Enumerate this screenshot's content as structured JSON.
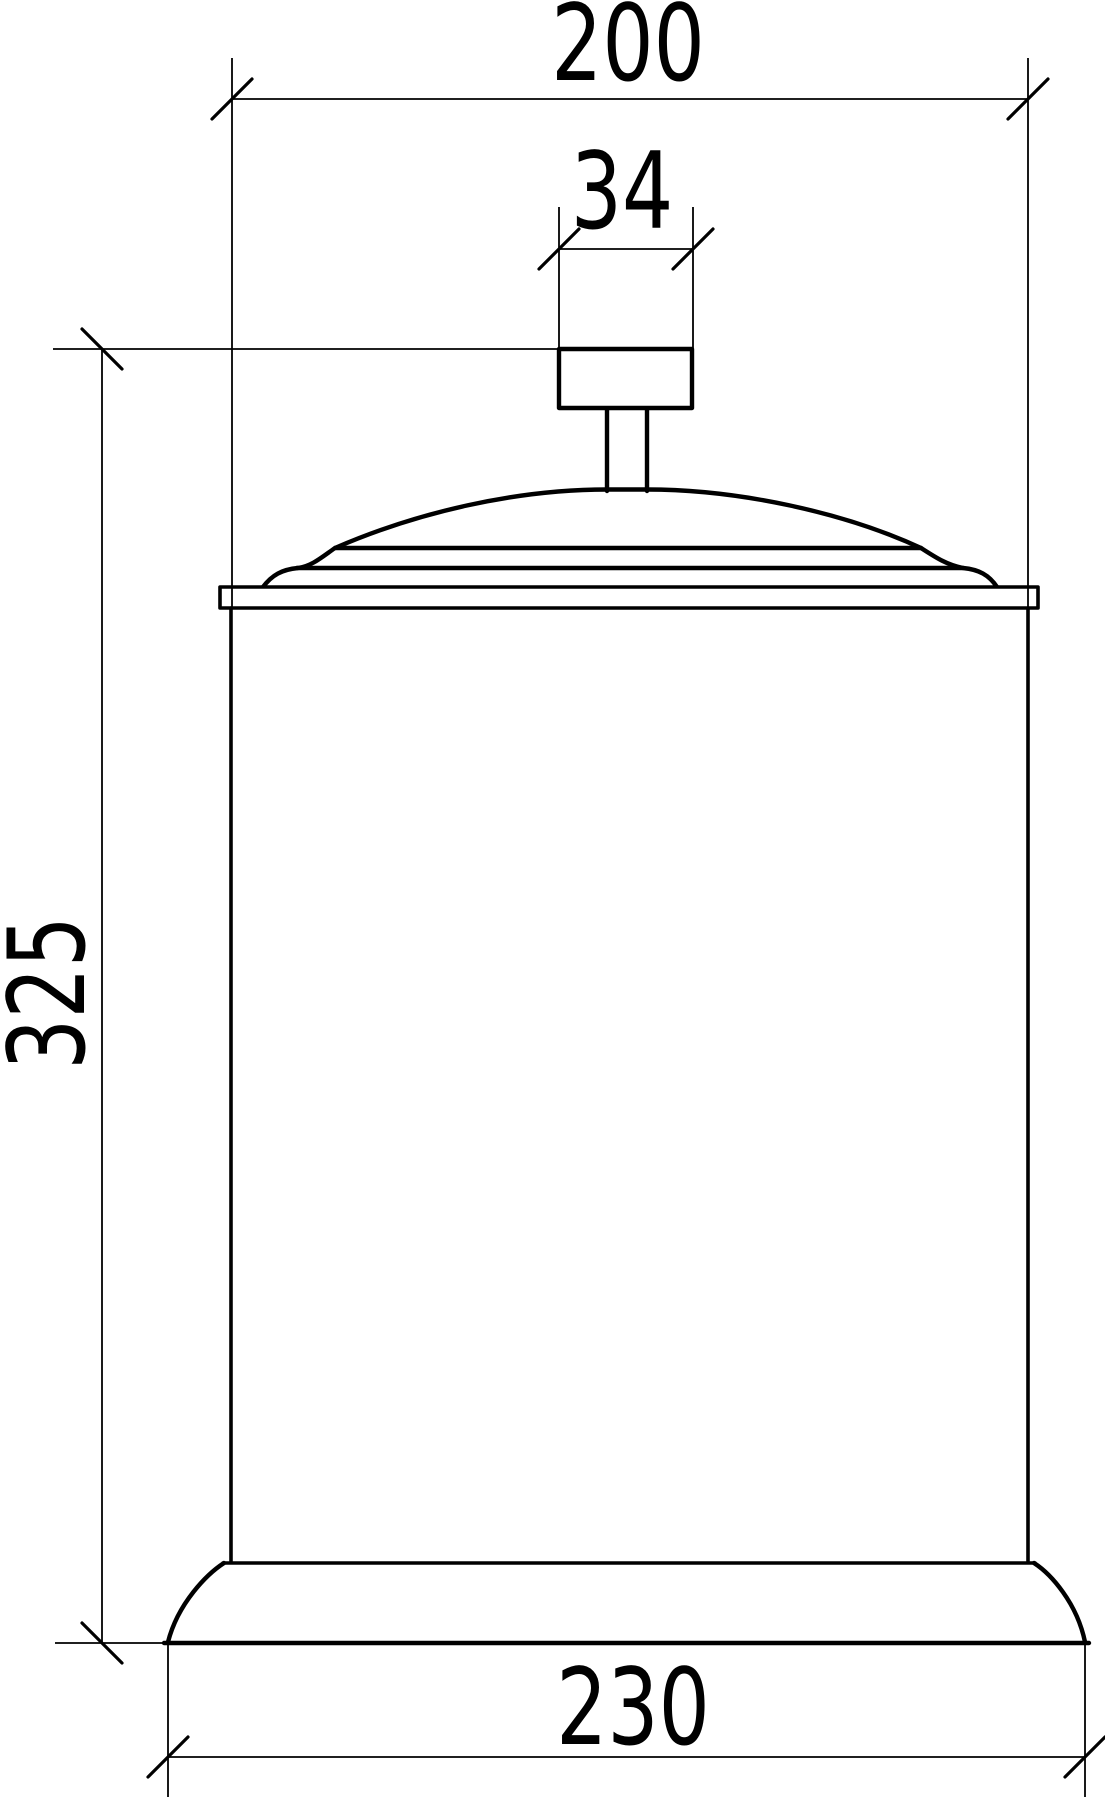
{
  "drawing": {
    "dimensions": {
      "top_width": {
        "label": "200"
      },
      "knob_width": {
        "label": "34"
      },
      "height": {
        "label": "325"
      },
      "base_width": {
        "label": "230"
      }
    },
    "colors": {
      "line": "#000000",
      "background": "#ffffff"
    }
  }
}
